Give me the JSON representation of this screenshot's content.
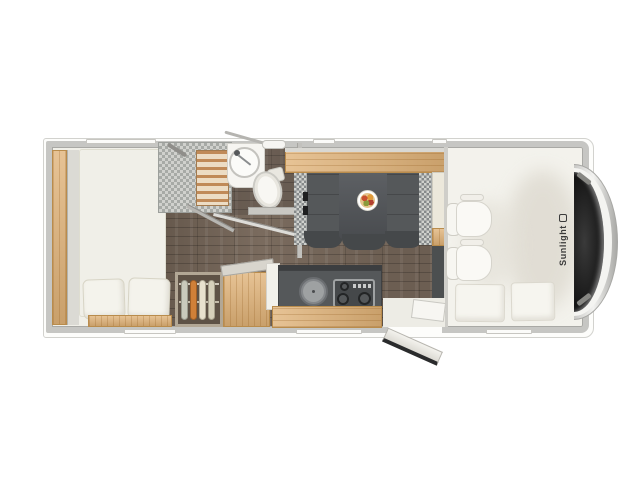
{
  "title": "Motorhome floor plan (top view)",
  "brand": {
    "label": "Sunlight"
  },
  "colors": {
    "body_wall": "#c6c6c3",
    "wood_accent": "#e0b277",
    "floor_wood": "#7a6b5e",
    "upholstery_dark": "#55585a",
    "mattress_cream": "#f0efe8",
    "windshield": "#1d1d1d",
    "brand_text": "#3a3a3a",
    "food_accent": "#d4722e"
  },
  "fixtures": [
    "rear-bed",
    "bed-pillows",
    "shower-cabin",
    "shower-duckboard",
    "washbasin",
    "toilet",
    "wardrobe-with-hangers",
    "lift-top-cabinet",
    "kitchen-sink",
    "gas-hob-3-burner",
    "kitchen-drawers",
    "overhead-locker",
    "dinette-table",
    "food-plate",
    "dinette-bench-left",
    "dinette-bench-right",
    "entry-door-open",
    "entry-step",
    "cab-seat-front",
    "cab-seat-rear",
    "cab-bed-cushions",
    "windshield",
    "side-mirror"
  ]
}
